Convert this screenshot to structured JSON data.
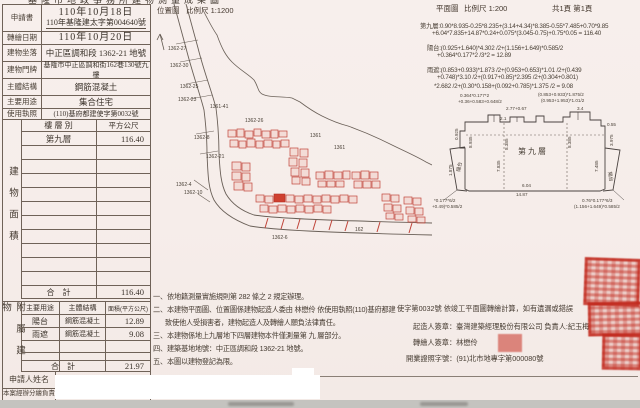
{
  "page": {
    "accent_red": "#c03a2c"
  },
  "top": {
    "title_partial": "基隆市地政事務所建物測量成果圖",
    "loc_label": "位置圖",
    "loc_scale": "比例尺 1:1200",
    "plan_label": "平面圖",
    "plan_scale": "比例尺 1:200",
    "pages": "共1頁 第1頁"
  },
  "info": {
    "rows": [
      {
        "label": "申請書",
        "value": "110年10月18日",
        "value2": "110年基隆建太字第004640號"
      },
      {
        "label": "轉繪日期",
        "value": "110年10月20日"
      },
      {
        "label": "建物坐落",
        "value": "中正區調和段 1362-21 地號"
      },
      {
        "label": "建物門牌",
        "value": "基隆市中正區調和街162巷130號九樓"
      },
      {
        "label": "主體結構",
        "value": "鋼筋混凝土"
      },
      {
        "label": "主要用途",
        "value": "集合住宅"
      },
      {
        "label": "使用執照",
        "value": "(110)基府都建使字第0032號"
      }
    ]
  },
  "area_table": {
    "side_label": "建物面積",
    "col1": "樓 層 別",
    "col2": "平方公尺",
    "floor": "第九層",
    "area": "116.40",
    "total_label": "合　計",
    "total": "116.40"
  },
  "attached_table": {
    "side_label": "附屬建物",
    "col1": "主要用途",
    "col2": "主體結構",
    "col3": "面積(平方公尺)",
    "rows": [
      {
        "use": "陽台",
        "structure": "鋼筋混凝土",
        "area": "12.89"
      },
      {
        "use": "雨遮",
        "structure": "鋼筋混凝土",
        "area": "9.08"
      }
    ],
    "total_label": "合　計",
    "total": "21.97"
  },
  "applicant_label": "申請人姓名",
  "handler_label": "本案經辦分繪負責",
  "calc": {
    "lines": [
      "第九層:0.90*8.935-0.25*8.235+(3.14+4.34)*8.385-0.55*7.485+0.70*9.85",
      "+6.04*7.835+14.87*0.24+0.075*(3.045-0.75)+0.75*0.05 = 116.40",
      "陽台:(0.925+1.640)*4.302 /2+(1.156+1.649)*0.585/2",
      "+0.364*0.177*2 /3*2 = 12.89",
      "雨遮:(0.853+0.933)*1.873 /2+(0.953+0.653)*1.01 /2+(0.439",
      "+0.748)*3.10 /2+(0.917+0.85)*2.395 /2+(0.304+0.801)",
      "*2.682 /2+(0.30*0.158+(0.092+0.785)*1.375 /2 = 9.08"
    ]
  },
  "notes": {
    "lines": [
      "一、依地籍測量實施規則第 282 條之 2 規定辦理。",
      "二、本建物平面圖、位置圖係建物起造人委由 林懋伶 依使用執照(110)基府都建",
      "致使他人受損害者，建物起造人及轉繪人願負法律責任。",
      "三、本建物係地上九層地下四層建物本件僅測量第 九 層部分。",
      "四、建築基地地號：中正區調和段 1362-21 地號。",
      "五、本圖以建物登記為限。"
    ]
  },
  "sign": {
    "cont": "使字第0032號 依竣工平面圖轉繪計算，如有遺漏或錯誤",
    "builder": "起造人簽章：臺灣建築經理股份有限公司 負責人:紀玉梅",
    "drafter": "轉繪人簽章：林懋伶",
    "license": "開業證照字號：(91)北市地專字第000080號"
  },
  "map": {
    "labels": [
      "1362-27",
      "1362-30",
      "1362-25",
      "1362-23",
      "1361-41",
      "1362-8",
      "1362-21",
      "1362-26",
      "1361",
      "1361",
      "1362-4",
      "1362-10",
      "1362-6",
      "162"
    ]
  },
  "plan": {
    "center_label": "第九層",
    "balcony_left": "陽台",
    "balcony_right": "陽台",
    "dims": [
      "0.364*0.177*2",
      "+0.36+0.583+0.648/2",
      "(0.853+0.933)*1.875/2",
      "(0.953+1.953)*1.01/2",
      "2.77+0.67",
      "2.1",
      "3.4",
      "0.55",
      "8.935",
      "8.385",
      "7.835",
      "8.385",
      "7.485",
      "3.975",
      "6.04",
      "14.87",
      "0.925",
      "*0.177*6/2",
      "+0.49)*0.585/2",
      "0.76*0.177*6/3",
      "(1.156+1.649)*0.585/2",
      "1.875"
    ]
  }
}
